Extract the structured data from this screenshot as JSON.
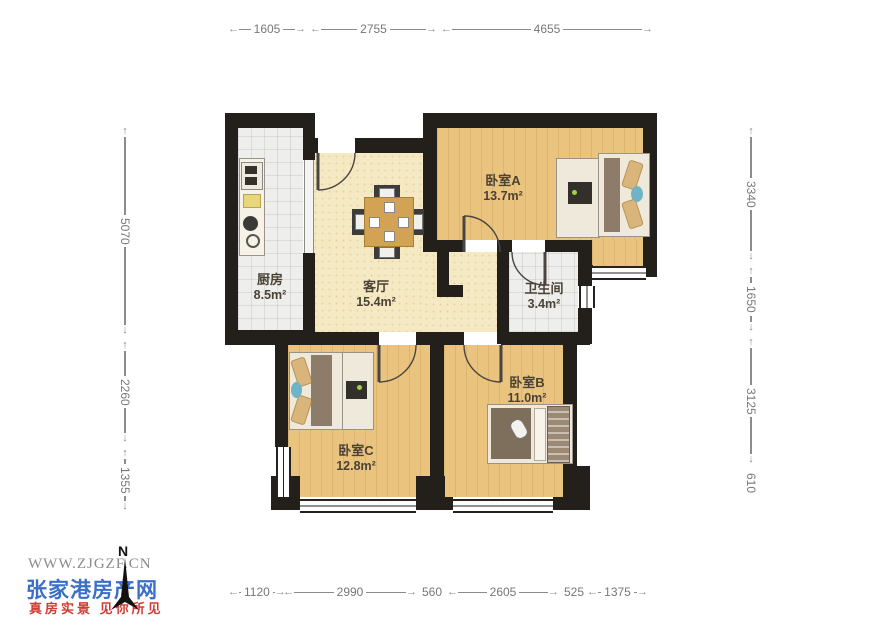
{
  "rooms": {
    "kitchen": {
      "name": "厨房",
      "area": "8.5m²"
    },
    "living": {
      "name": "客厅",
      "area": "15.4m²"
    },
    "bedroomA": {
      "name": "卧室A",
      "area": "13.7m²"
    },
    "bathroom": {
      "name": "卫生间",
      "area": "3.4m²"
    },
    "bedroomB": {
      "name": "卧室B",
      "area": "11.0m²"
    },
    "bedroomC": {
      "name": "卧室C",
      "area": "12.8m²"
    }
  },
  "dimensions": {
    "top": [
      "1605",
      "2755",
      "4655"
    ],
    "bottom": [
      "1120",
      "2990",
      "560",
      "2605",
      "525",
      "1375"
    ],
    "left": [
      "5070",
      "2260",
      "1355"
    ],
    "right": [
      "3340",
      "1650",
      "3125",
      "610"
    ]
  },
  "watermark": {
    "url": "WWW.ZJGZF.CN",
    "site_name": "张家港房产网",
    "slogan": "真房实景 见你所见",
    "north_label": "N"
  },
  "colors": {
    "wall": "#23201c",
    "wood_floor": "#eac47e",
    "living_floor": "#f5e9c3",
    "tile_floor": "#eeeeec",
    "brand_blue": "#3a6fc9",
    "brand_red": "#d23b33"
  }
}
